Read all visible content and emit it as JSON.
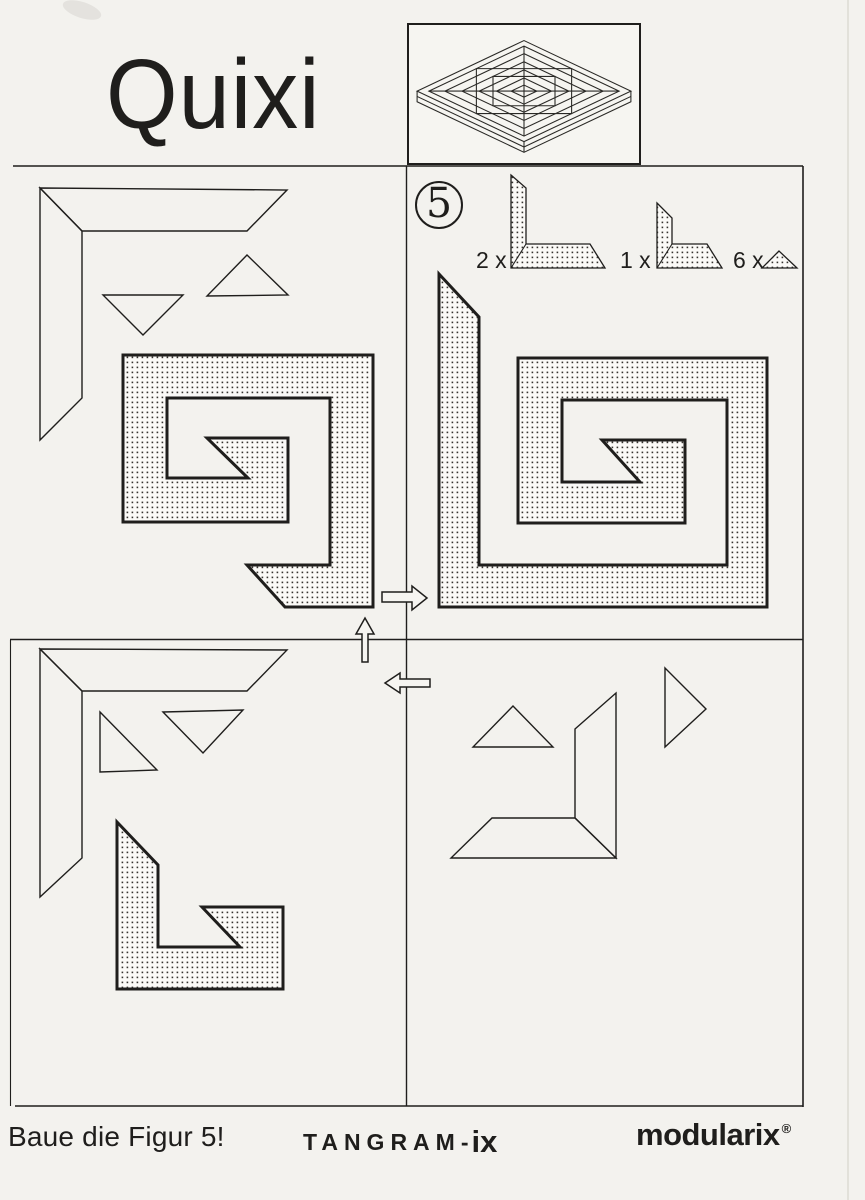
{
  "style": {
    "ink": "#1f1e1c",
    "paper": "#f3f2ee",
    "piece_background": "#fbfaf7",
    "dot_color": "#35332f",
    "arrow_fill": "#f6f5f1",
    "edge_shadow": "#dddbd4"
  },
  "header": {
    "title": "Quixi"
  },
  "inventory": {
    "figure_number": "5",
    "items": [
      {
        "count": "2 x",
        "piece": "large-l-piece"
      },
      {
        "count": "1 x",
        "piece": "small-l-piece"
      },
      {
        "count": "6 x",
        "piece": "triangle-piece"
      }
    ]
  },
  "footer": {
    "caption": "Baue die Figur 5!",
    "brand_prefix": "TANGRAM-",
    "brand_suffix": "ix",
    "logo_text": "modularix",
    "registered_mark": "®"
  },
  "frame": {
    "lines": [
      {
        "name": "header-rule",
        "xy": [
          13,
          166,
          803,
          166
        ],
        "w": 1.6
      },
      {
        "name": "vertical-divider",
        "xy": [
          406.5,
          166,
          406.5,
          1106
        ],
        "w": 1.4
      },
      {
        "name": "horizontal-divider",
        "xy": [
          10,
          639.5,
          803,
          639.5
        ],
        "w": 1.4
      },
      {
        "name": "right-border",
        "xy": [
          803,
          166,
          803,
          1107
        ],
        "w": 1.6
      },
      {
        "name": "bottom-rule",
        "xy": [
          15,
          1106,
          803,
          1106
        ],
        "w": 1.6
      },
      {
        "name": "left-border",
        "xy": [
          10.5,
          640,
          10.5,
          1106
        ],
        "w": 1.1
      },
      {
        "name": "page-edge-shadow",
        "xy": [
          848,
          0,
          848,
          1200
        ],
        "w": 1.5,
        "c": "#dddbd4"
      }
    ]
  },
  "figures": [
    {
      "name": "tl-corner-horizontal-outline",
      "type": "polygon",
      "fill": "none",
      "sw": 1.4,
      "points": [
        [
          40,
          188
        ],
        [
          287,
          190
        ],
        [
          247,
          231
        ],
        [
          82,
          231
        ]
      ]
    },
    {
      "name": "tl-corner-vertical-outline",
      "type": "polygon",
      "fill": "none",
      "sw": 1.4,
      "points": [
        [
          40,
          188
        ],
        [
          82,
          231
        ],
        [
          82,
          398
        ],
        [
          40,
          440
        ]
      ]
    },
    {
      "name": "tl-triangle-down-outline",
      "type": "polygon",
      "fill": "none",
      "sw": 1.4,
      "points": [
        [
          103,
          295
        ],
        [
          183,
          295
        ],
        [
          143,
          335
        ]
      ]
    },
    {
      "name": "tl-triangle-up-outline",
      "type": "polygon",
      "fill": "none",
      "sw": 1.4,
      "points": [
        [
          247,
          255
        ],
        [
          207,
          296
        ],
        [
          288,
          295
        ]
      ]
    },
    {
      "name": "tl-partial-spiral-dotted",
      "type": "polygon",
      "fill": "dots",
      "sw": 3,
      "points": [
        [
          123,
          355
        ],
        [
          373,
          355
        ],
        [
          373,
          607
        ],
        [
          285,
          607
        ],
        [
          247,
          565
        ],
        [
          330,
          565
        ],
        [
          330,
          398
        ],
        [
          167,
          398
        ],
        [
          167,
          478
        ],
        [
          248,
          478
        ],
        [
          207,
          438
        ],
        [
          288,
          438
        ],
        [
          288,
          522
        ],
        [
          123,
          522
        ]
      ]
    },
    {
      "name": "tr-figure5-spiral-dotted",
      "type": "polygon",
      "fill": "dots",
      "sw": 3,
      "points": [
        [
          439,
          274
        ],
        [
          479,
          317
        ],
        [
          479,
          565
        ],
        [
          727,
          565
        ],
        [
          727,
          400
        ],
        [
          562,
          400
        ],
        [
          562,
          482
        ],
        [
          640,
          482
        ],
        [
          602,
          440
        ],
        [
          685,
          440
        ],
        [
          685,
          523
        ],
        [
          518,
          523
        ],
        [
          518,
          358
        ],
        [
          767,
          358
        ],
        [
          767,
          607
        ],
        [
          439,
          607
        ]
      ]
    },
    {
      "name": "inventory-large-l-piece-dotted",
      "type": "polygon",
      "fill": "dots",
      "sw": 1.3,
      "points": [
        [
          511,
          175
        ],
        [
          526,
          188
        ],
        [
          526,
          244
        ],
        [
          590,
          244
        ],
        [
          605,
          268
        ],
        [
          511,
          268
        ]
      ]
    },
    {
      "name": "inventory-large-l-miter-seam",
      "type": "line",
      "sw": 1.1,
      "points": [
        [
          526,
          244
        ],
        [
          511,
          268
        ]
      ]
    },
    {
      "name": "inventory-small-l-piece-dotted",
      "type": "polygon",
      "fill": "dots",
      "sw": 1.3,
      "points": [
        [
          657,
          203
        ],
        [
          672,
          218
        ],
        [
          672,
          244
        ],
        [
          707,
          244
        ],
        [
          722,
          268
        ],
        [
          657,
          268
        ]
      ]
    },
    {
      "name": "inventory-small-l-miter-seam",
      "type": "line",
      "sw": 1.1,
      "points": [
        [
          672,
          244
        ],
        [
          657,
          268
        ]
      ]
    },
    {
      "name": "inventory-triangle-piece-dotted",
      "type": "polygon",
      "fill": "dots",
      "sw": 1.3,
      "points": [
        [
          779,
          251
        ],
        [
          762,
          268
        ],
        [
          797,
          268
        ]
      ]
    },
    {
      "name": "bl-corner-horizontal-outline",
      "type": "polygon",
      "fill": "none",
      "sw": 1.4,
      "points": [
        [
          40,
          649
        ],
        [
          287,
          650
        ],
        [
          247,
          691
        ],
        [
          82,
          691
        ]
      ]
    },
    {
      "name": "bl-corner-vertical-outline",
      "type": "polygon",
      "fill": "none",
      "sw": 1.4,
      "points": [
        [
          40,
          649
        ],
        [
          82,
          691
        ],
        [
          82,
          858
        ],
        [
          40,
          897
        ]
      ]
    },
    {
      "name": "bl-right-angle-triangle-outline",
      "type": "polygon",
      "fill": "none",
      "sw": 1.4,
      "points": [
        [
          100,
          712
        ],
        [
          100,
          772
        ],
        [
          157,
          770
        ]
      ]
    },
    {
      "name": "bl-triangle-down-outline",
      "type": "polygon",
      "fill": "none",
      "sw": 1.4,
      "points": [
        [
          163,
          712
        ],
        [
          243,
          710
        ],
        [
          203,
          753
        ]
      ]
    },
    {
      "name": "bl-interlocked-l-pieces-dotted",
      "type": "polygon",
      "fill": "dots",
      "sw": 3,
      "points": [
        [
          117,
          822
        ],
        [
          158,
          865
        ],
        [
          158,
          947
        ],
        [
          240,
          947
        ],
        [
          202,
          907
        ],
        [
          283,
          907
        ],
        [
          283,
          989
        ],
        [
          117,
          989
        ]
      ]
    },
    {
      "name": "br-triangle-up-outline",
      "type": "polygon",
      "fill": "none",
      "sw": 1.4,
      "points": [
        [
          513,
          706
        ],
        [
          473,
          747
        ],
        [
          553,
          747
        ]
      ]
    },
    {
      "name": "br-corner-vertical-outline",
      "type": "polygon",
      "fill": "none",
      "sw": 1.4,
      "points": [
        [
          575,
          729
        ],
        [
          616,
          693
        ],
        [
          616,
          858
        ],
        [
          575,
          818
        ]
      ]
    },
    {
      "name": "br-corner-horizontal-outline",
      "type": "polygon",
      "fill": "none",
      "sw": 1.4,
      "points": [
        [
          492,
          818
        ],
        [
          575,
          818
        ],
        [
          616,
          858
        ],
        [
          451,
          858
        ]
      ]
    },
    {
      "name": "br-triangle-right-outline",
      "type": "polygon",
      "fill": "none",
      "sw": 1.4,
      "points": [
        [
          665,
          668
        ],
        [
          706,
          709
        ],
        [
          665,
          747
        ]
      ]
    },
    {
      "name": "arrow-right",
      "type": "polygon",
      "fill": "paper",
      "sw": 1.5,
      "points": [
        [
          382,
          592
        ],
        [
          412,
          592
        ],
        [
          412,
          586
        ],
        [
          427,
          598
        ],
        [
          412,
          610
        ],
        [
          412,
          602
        ],
        [
          382,
          602
        ]
      ]
    },
    {
      "name": "arrow-up",
      "type": "polygon",
      "fill": "paper",
      "sw": 1.5,
      "points": [
        [
          362,
          662
        ],
        [
          362,
          634
        ],
        [
          356,
          634
        ],
        [
          365,
          618
        ],
        [
          374,
          634
        ],
        [
          368,
          634
        ],
        [
          368,
          662
        ]
      ]
    },
    {
      "name": "arrow-left",
      "type": "polygon",
      "fill": "paper",
      "sw": 1.5,
      "points": [
        [
          430,
          679
        ],
        [
          400,
          679
        ],
        [
          400,
          673
        ],
        [
          385,
          683
        ],
        [
          400,
          693
        ],
        [
          400,
          687
        ],
        [
          430,
          687
        ]
      ]
    }
  ]
}
